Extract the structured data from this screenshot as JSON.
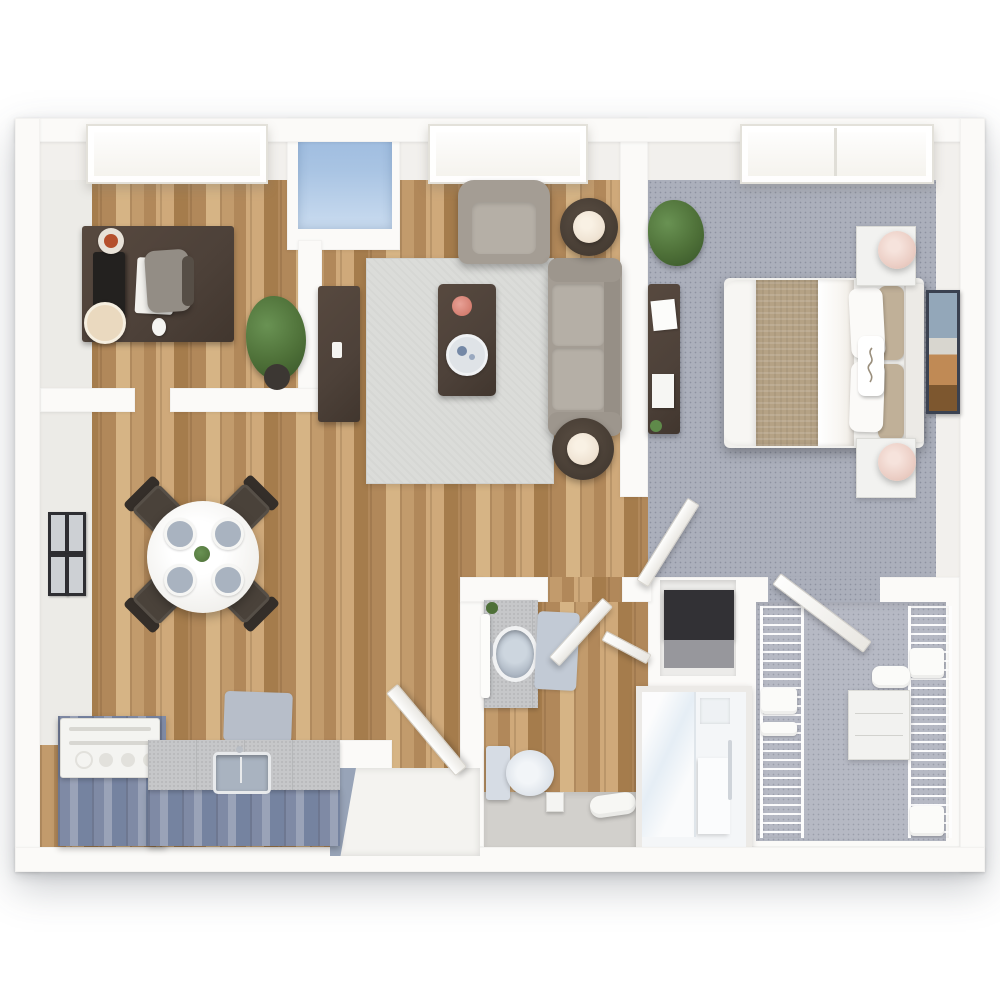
{
  "meta": {
    "type": "3d-floor-plan-rendering",
    "view": "top-down",
    "unit": "one-bedroom apartment with den, one bathroom and walk-in closet"
  },
  "palette": {
    "page_bg": "#ffffff",
    "wall": "#fbfaf8",
    "wall_face": "#f2f0ed",
    "wall_face_left": "#ecebe7",
    "wood_a": "#c29b6c",
    "wood_b": "#b1885a",
    "wood_c": "#cfa97a",
    "wood_d": "#a57c4c",
    "wood_e": "#d6b485",
    "carpet": "#abafbb",
    "closet_carpet": "#b6b9c4",
    "rug": "#dbdcd9",
    "cabinet_blue": "#7f8aa5",
    "cabinet_blue_light": "#9aa3b8",
    "counter": "#c6c7c9",
    "dark_wood": "#4d4139",
    "sofa": "#a49d94",
    "sofa_light": "#b5afa6",
    "bed_blanket": "#b5a285",
    "bedding": "#f8f6f2",
    "headboard": "#eceae6",
    "lamp_blush": "#eccfc6",
    "lamp_cream": "#efe3d3",
    "glass_blue": "#a9c4e3",
    "glass_blue_dark": "#3b4f6b",
    "fixture": "#dde3ea",
    "fixture_deep": "#a9b3c0",
    "bath_mat": "#c2cad5",
    "plant": "#4e7038",
    "plant_light": "#699253",
    "frame_dark": "#2e2e32",
    "art_frame": "#3a4150",
    "gray_floor": "#d2d0cc",
    "mat_gray": "#b7bec9",
    "white_goods": "#f4f4f1",
    "shadow": "rgba(70,75,85,0.28)"
  },
  "scene": {
    "rooms": [
      {
        "name": "den",
        "floor": "hardwood",
        "items": [
          "desk",
          "monitor",
          "keyboard",
          "mouse",
          "coffee-cup",
          "plate",
          "desk-chair",
          "potted-plant"
        ]
      },
      {
        "name": "living-room",
        "floor": "hardwood",
        "items": [
          "area-rug",
          "armchair",
          "sofa",
          "coffee-table",
          "flower-vase",
          "serving-tray",
          "tv-console",
          "remote",
          "side-table-lamp-north",
          "side-table-lamp-south"
        ]
      },
      {
        "name": "dining-area",
        "floor": "hardwood",
        "items": [
          "round-dining-table",
          "dining-chairs-4",
          "place-settings-4",
          "centerpiece-plant",
          "gallery-wall-frames-4"
        ]
      },
      {
        "name": "kitchen",
        "floor": "hardwood",
        "items": [
          "range",
          "counter-cabinets",
          "sink",
          "floor-mat"
        ]
      },
      {
        "name": "bedroom",
        "floor": "carpet",
        "items": [
          "bed",
          "tan-blanket",
          "pillows",
          "headboard",
          "nightstand-north",
          "nightstand-south",
          "table-lamps-2",
          "dresser-desk",
          "papers",
          "wall-art",
          "potted-plant"
        ]
      },
      {
        "name": "bathroom",
        "floor": "hardwood-and-tile",
        "items": [
          "vanity-sink",
          "hand-towel",
          "bath-mat",
          "toilet",
          "waste-bin",
          "rolled-towel",
          "glass-shower",
          "shower-bench"
        ]
      },
      {
        "name": "walk-in-closet",
        "floor": "carpet",
        "items": [
          "wire-shelving-left",
          "wire-shelving-right",
          "dresser",
          "linen-stacks"
        ]
      },
      {
        "name": "entry",
        "items": [
          "entry-alcove",
          "entry-door"
        ]
      },
      {
        "name": "storage-niche",
        "items": [
          "storage-cabinet"
        ]
      }
    ],
    "windows": [
      "den-window",
      "blue-transom-niche-window",
      "living-room-window",
      "bedroom-window"
    ],
    "doors": [
      "entry-door",
      "bathroom-door",
      "shower-door",
      "bedroom-door",
      "closet-door"
    ]
  }
}
